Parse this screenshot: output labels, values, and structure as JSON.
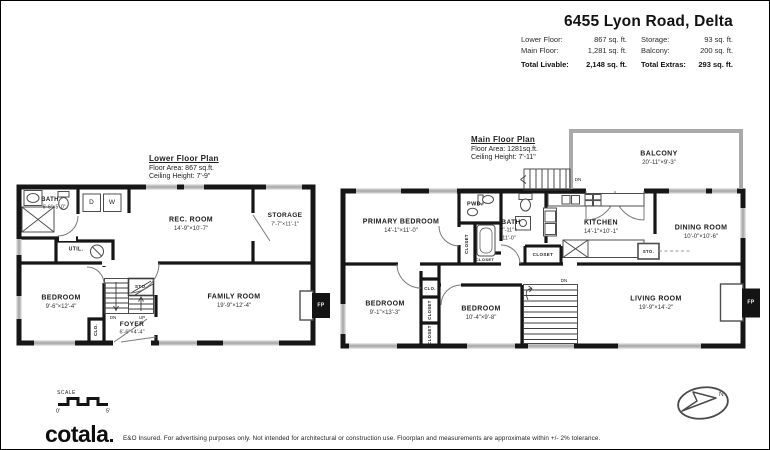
{
  "header": {
    "title": "6455 Lyon Road, Delta",
    "columns": [
      {
        "rows": [
          {
            "label": "Lower Floor:",
            "value": "867 sq. ft."
          },
          {
            "label": "Main Floor:",
            "value": "1,281 sq. ft."
          }
        ],
        "total": {
          "label": "Total Livable:",
          "value": "2,148 sq. ft."
        }
      },
      {
        "rows": [
          {
            "label": "Storage:",
            "value": "93 sq. ft."
          },
          {
            "label": "Balcony:",
            "value": "200 sq. ft."
          }
        ],
        "total": {
          "label": "Total Extras:",
          "value": "293 sq. ft."
        }
      }
    ]
  },
  "lower_plan": {
    "title": "Lower Floor Plan",
    "floor_area": "Floor Area: 867 sq.ft.",
    "ceiling_height": "Ceiling Height: 7'-9\"",
    "rooms": {
      "bath": {
        "name": "BATH",
        "dim": "6'-6\"×5'-0\""
      },
      "dryer": "D",
      "washer": "W",
      "rec_room": {
        "name": "REC. ROOM",
        "dim": "14'-9\"×10'-7\""
      },
      "storage": {
        "name": "STORAGE",
        "dim": "7'-7\"×11'-1\""
      },
      "util": "UTIL.",
      "bedroom": {
        "name": "BEDROOM",
        "dim": "9'-6\"×12'-4\""
      },
      "sto": "STO.",
      "dn": "DN",
      "up": "UP",
      "family_room": {
        "name": "FAMILY ROOM",
        "dim": "19'-9\"×12'-4\""
      },
      "foyer": {
        "name": "FOYER",
        "dim": "6'-6\"×4'-4\""
      },
      "clo": "CLO.",
      "fireplace": "FP"
    }
  },
  "main_plan": {
    "title": "Main Floor Plan",
    "floor_area": "Floor Area: 1281sq.ft.",
    "ceiling_height": "Ceiling Height: 7'-11\"",
    "rooms": {
      "balcony": {
        "name": "BALCONY",
        "dim": "20'-11\"×9'-3\""
      },
      "dn_balcony": "DN",
      "primary_bedroom": {
        "name": "PRIMARY BEDROOM",
        "dim": "14'-1\"×11'-0\""
      },
      "pwd": "PWD.",
      "bath": {
        "name": "BATH",
        "dim1": "7'-11\"×",
        "dim2": "11'-0\""
      },
      "closet_bath": "CLOSET",
      "closet_tub": "CLOSET",
      "closet_hall": "CLOSET",
      "kitchen": {
        "name": "KITCHEN",
        "dim": "14'-1\"×10'-1\""
      },
      "sto": "STO.",
      "dining_room": {
        "name": "DINING ROOM",
        "dim": "10'-0\"×10'-6\""
      },
      "bedroom_2": {
        "name": "BEDROOM",
        "dim": "9'-1\"×13'-3\""
      },
      "clo": "CLO.",
      "closet_a": "CLOSET",
      "closet_b": "CLOSET",
      "bedroom_3": {
        "name": "BEDROOM",
        "dim": "10'-4\"×9'-8\""
      },
      "dn_stairs": "DN",
      "living_room": {
        "name": "LIVING ROOM",
        "dim": "19'-9\"×14'-2\""
      },
      "fireplace": "FP"
    }
  },
  "scale": {
    "label": "SCALE",
    "start": "0'",
    "end": "5'"
  },
  "compass": {
    "north": "N"
  },
  "footer": {
    "logo": "cotala",
    "disclaimer": "E&O Insured. For advertising purposes only. Not intended for architectural or construction use. Floorplan and measurements are approximate within +/- 2% tolerance."
  }
}
